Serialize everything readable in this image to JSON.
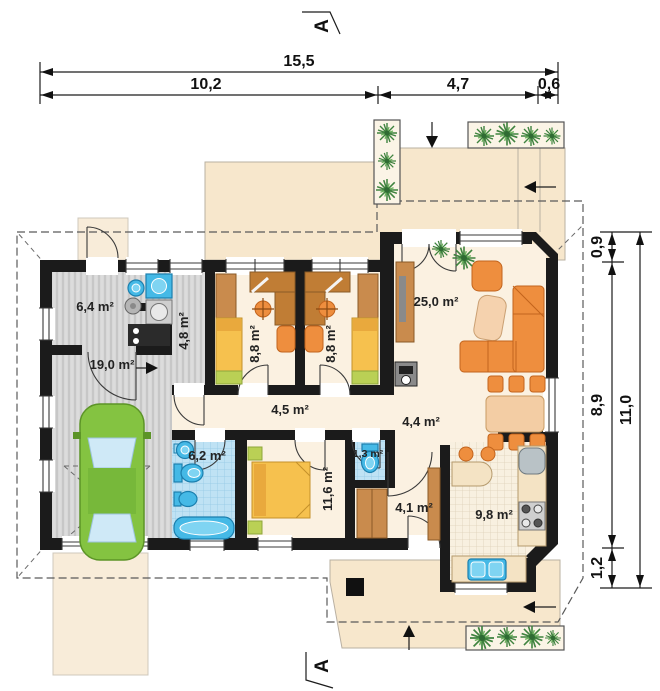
{
  "title": "single-storey house floor plan",
  "section_marker": "A",
  "dimensions_top": {
    "total": "15,5",
    "seg1": "10,2",
    "seg2": "4,7",
    "seg3": "0,6"
  },
  "dimensions_right": {
    "total": "11,0",
    "seg1": "0,9",
    "seg2": "8,9",
    "seg3": "1,2"
  },
  "rooms": {
    "utility": "6,4 m²",
    "corridor": "4,8 m²",
    "garage": "19,0 m²",
    "bedroom1": "8,8 m²",
    "bedroom2": "8,8 m²",
    "living": "25,0 m²",
    "hallway": "4,5 m²",
    "hall": "4,4 m²",
    "bathroom": "6,2 m²",
    "bedroom3": "11,6 m²",
    "wc": "1,3 m²",
    "entry": "4,1 m²",
    "kitchen": "9,8 m²"
  },
  "colors": {
    "wall": "#1b1b1b",
    "floor": "#fbf1e1",
    "terrace": "#f7e7cc",
    "garage_floor": "#dcdcdc",
    "tile_blue": "#bfe2f4",
    "tile_cream": "#f8f0e0",
    "furniture_orange": "#ee8e3e",
    "wood": "#c98b4d",
    "bed_yellow": "#f6c14e",
    "car_green": "#84c341",
    "sanitary_blue": "#45b9e6",
    "plant_green": "#4e9347"
  }
}
